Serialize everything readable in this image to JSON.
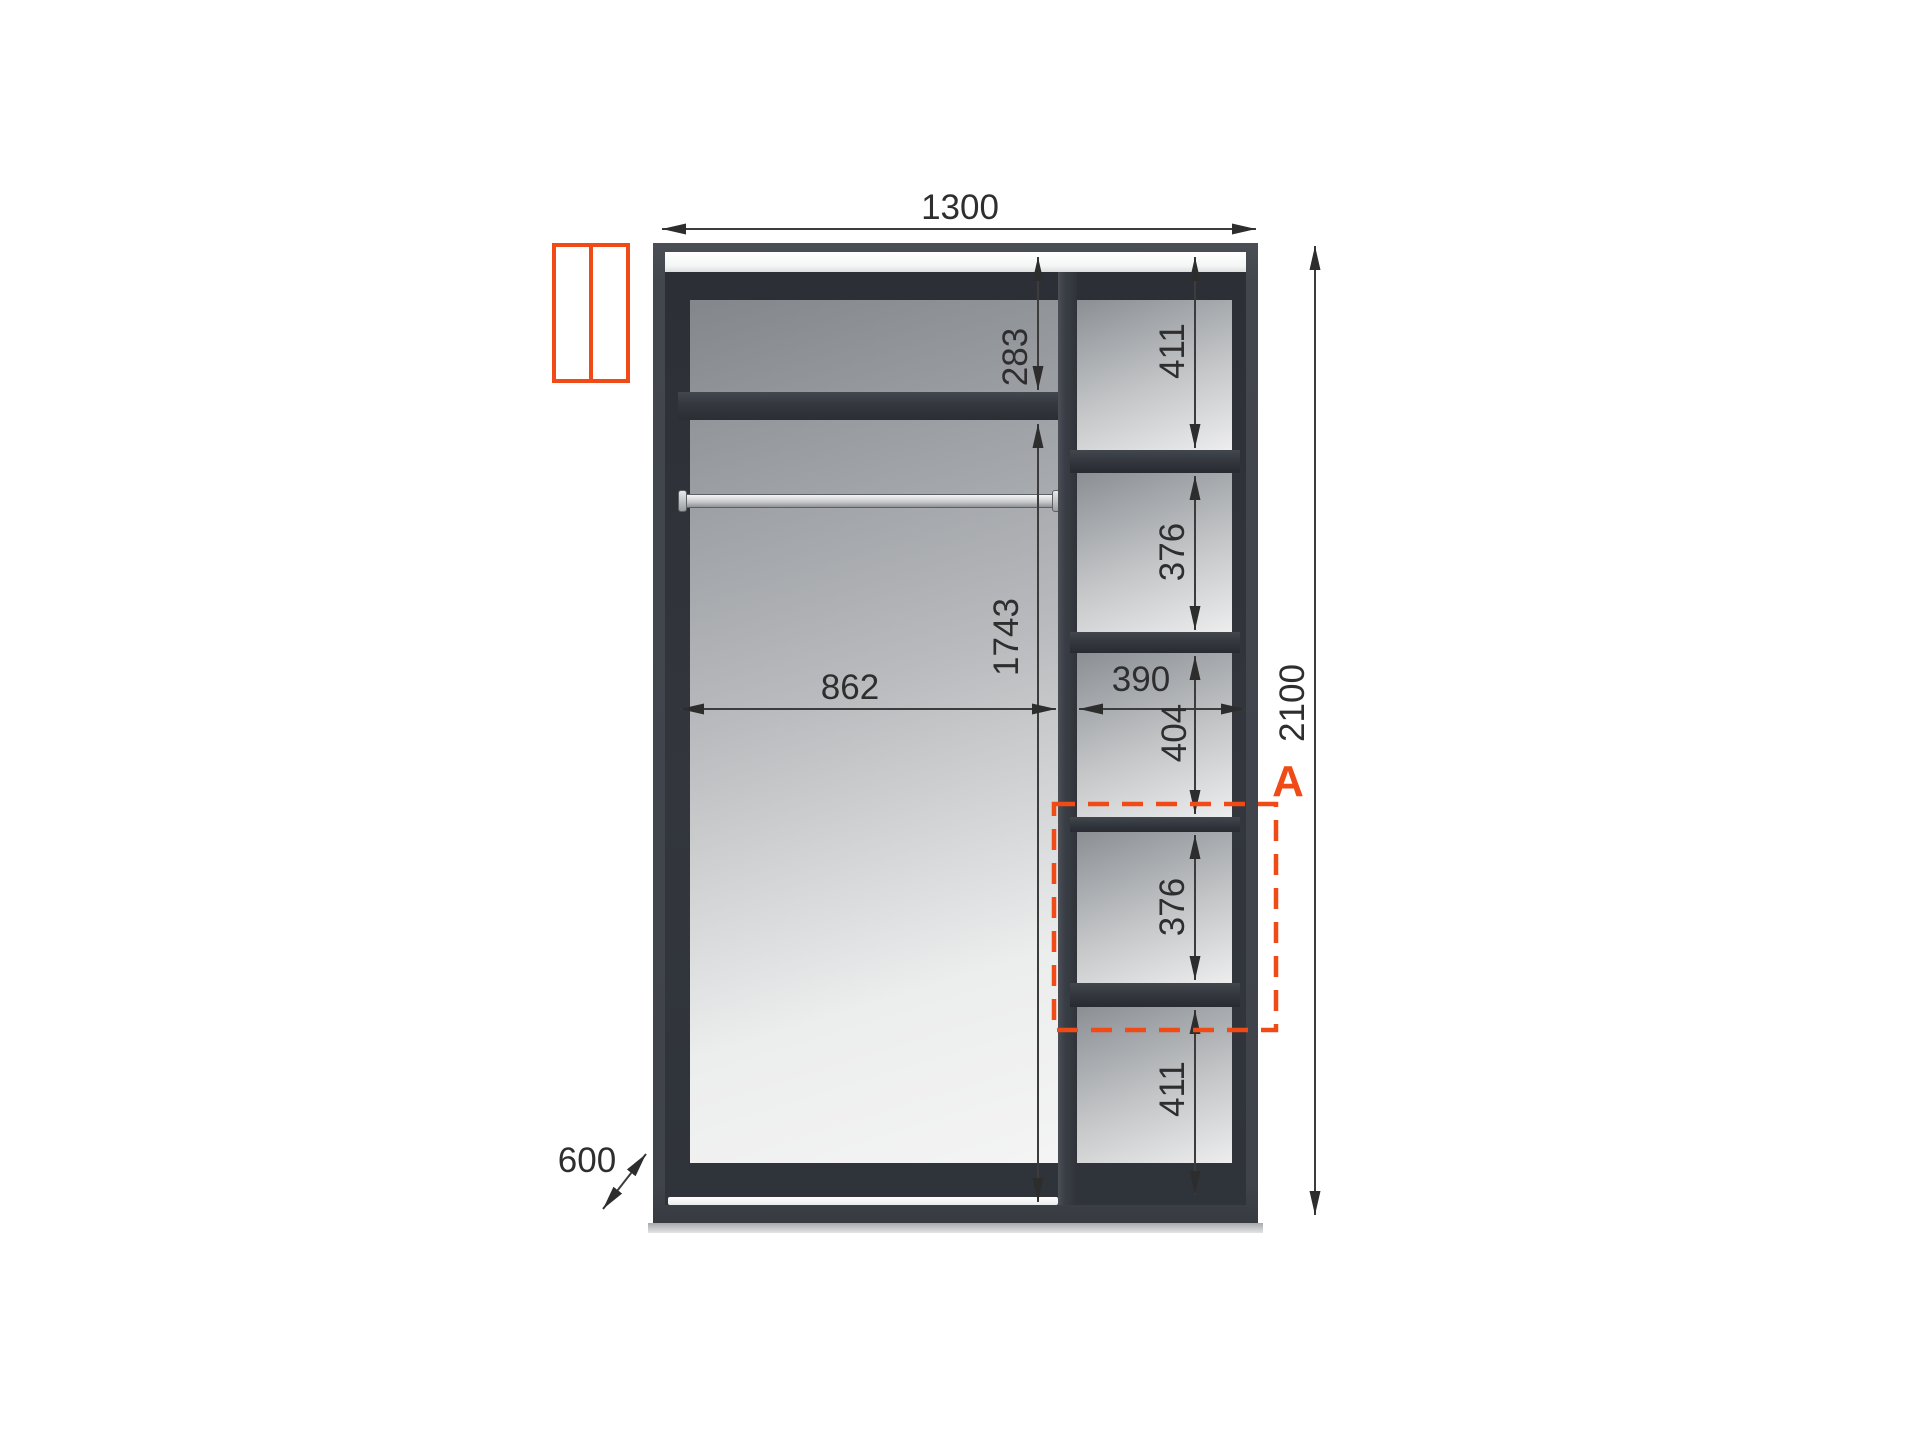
{
  "diagram_title": "wardrobe-interior-dimension-drawing",
  "colors": {
    "accent_orange": "#f04a17",
    "frame_dark": "#3f434a",
    "back_panel_light": "#f1f2f2",
    "dimension_line": "#3c3c3c",
    "background": "#ffffff"
  },
  "icons": {
    "sliding_doors": "two-panel rectangle outline"
  },
  "dims": {
    "width": "1300",
    "height": "2100",
    "depth": "600",
    "left_inner_width": "862",
    "right_inner_width": "390",
    "top_shelf_offset": "283",
    "hanging_height": "1743",
    "right_col_top": "411",
    "right_col_second": "376",
    "right_col_middle": "404",
    "right_col_fourth": "376",
    "right_col_bottom": "411",
    "section_marker": "A"
  }
}
